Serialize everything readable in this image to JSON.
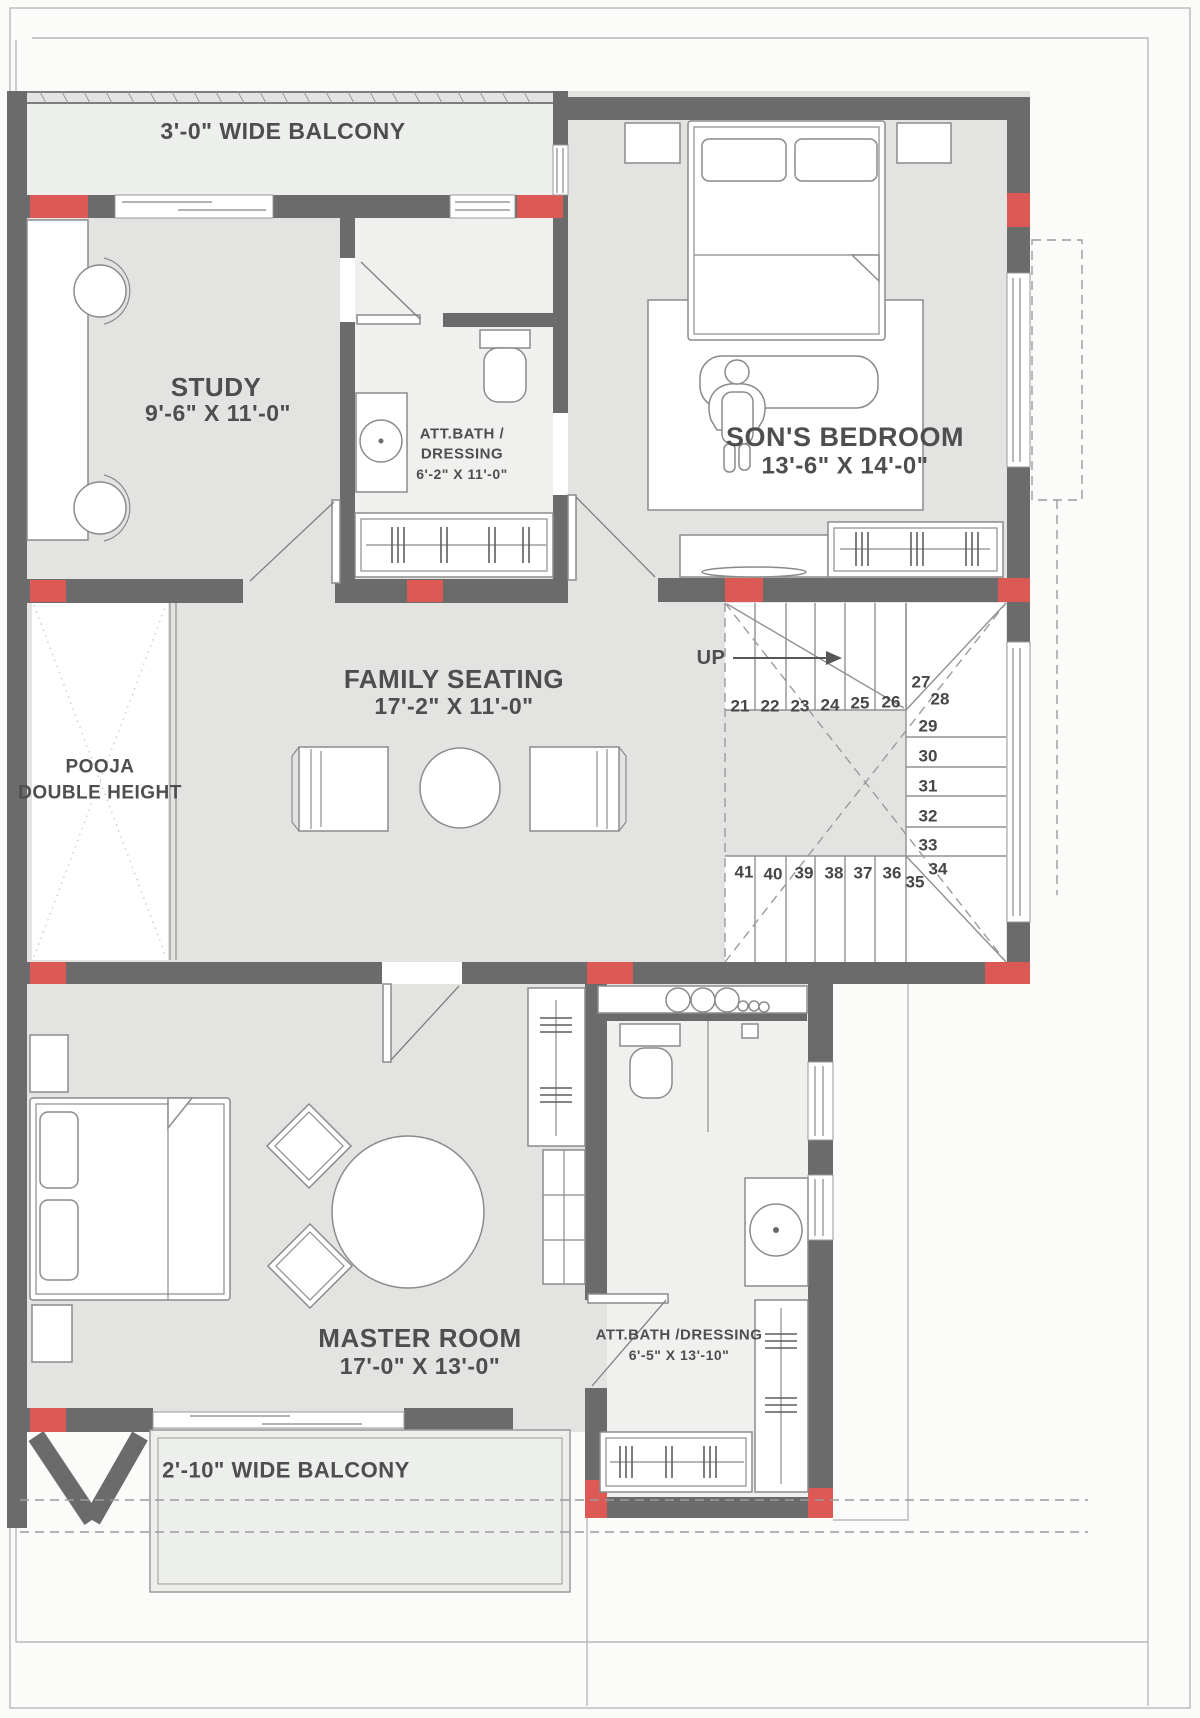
{
  "title": "First floor residential plan",
  "colors": {
    "wall": "#6b6b6b",
    "column_accent": "#dc5955",
    "room_fill": "#e3e4e1",
    "bath_fill": "#f0f1ee",
    "balcony_fill": "#edefec",
    "paper": "#fbfbfa",
    "text": "#4e4e4e"
  },
  "rooms": {
    "balcony_top": {
      "label": "3'-0\" WIDE BALCONY"
    },
    "study": {
      "label": "STUDY",
      "dims": "9'-6\" X 11'-0\""
    },
    "bath_top": {
      "label_line1": "ATT.BATH /",
      "label_line2": "DRESSING",
      "dims": "6'-2\" X 11'-0\""
    },
    "sons_bedroom": {
      "label": "SON'S BEDROOM",
      "dims": "13'-6\" X 14'-0\""
    },
    "family_seating": {
      "label": "FAMILY SEATING",
      "dims": "17'-2\" X 11'-0\""
    },
    "pooja": {
      "label_line1": "POOJA",
      "label_line2": "DOUBLE HEIGHT"
    },
    "master": {
      "label": "MASTER ROOM",
      "dims": "17'-0\" X 13'-0\""
    },
    "bath_master": {
      "label": "ATT.BATH /DRESSING",
      "dims": "6'-5\" X 13'-10\""
    },
    "balcony_bottom": {
      "label": "2'-10\" WIDE BALCONY"
    }
  },
  "stairs": {
    "direction_label": "UP",
    "numbers": [
      "21",
      "22",
      "23",
      "24",
      "25",
      "26",
      "27",
      "28",
      "29",
      "30",
      "31",
      "32",
      "33",
      "34",
      "35",
      "36",
      "37",
      "38",
      "39",
      "40",
      "41"
    ]
  }
}
